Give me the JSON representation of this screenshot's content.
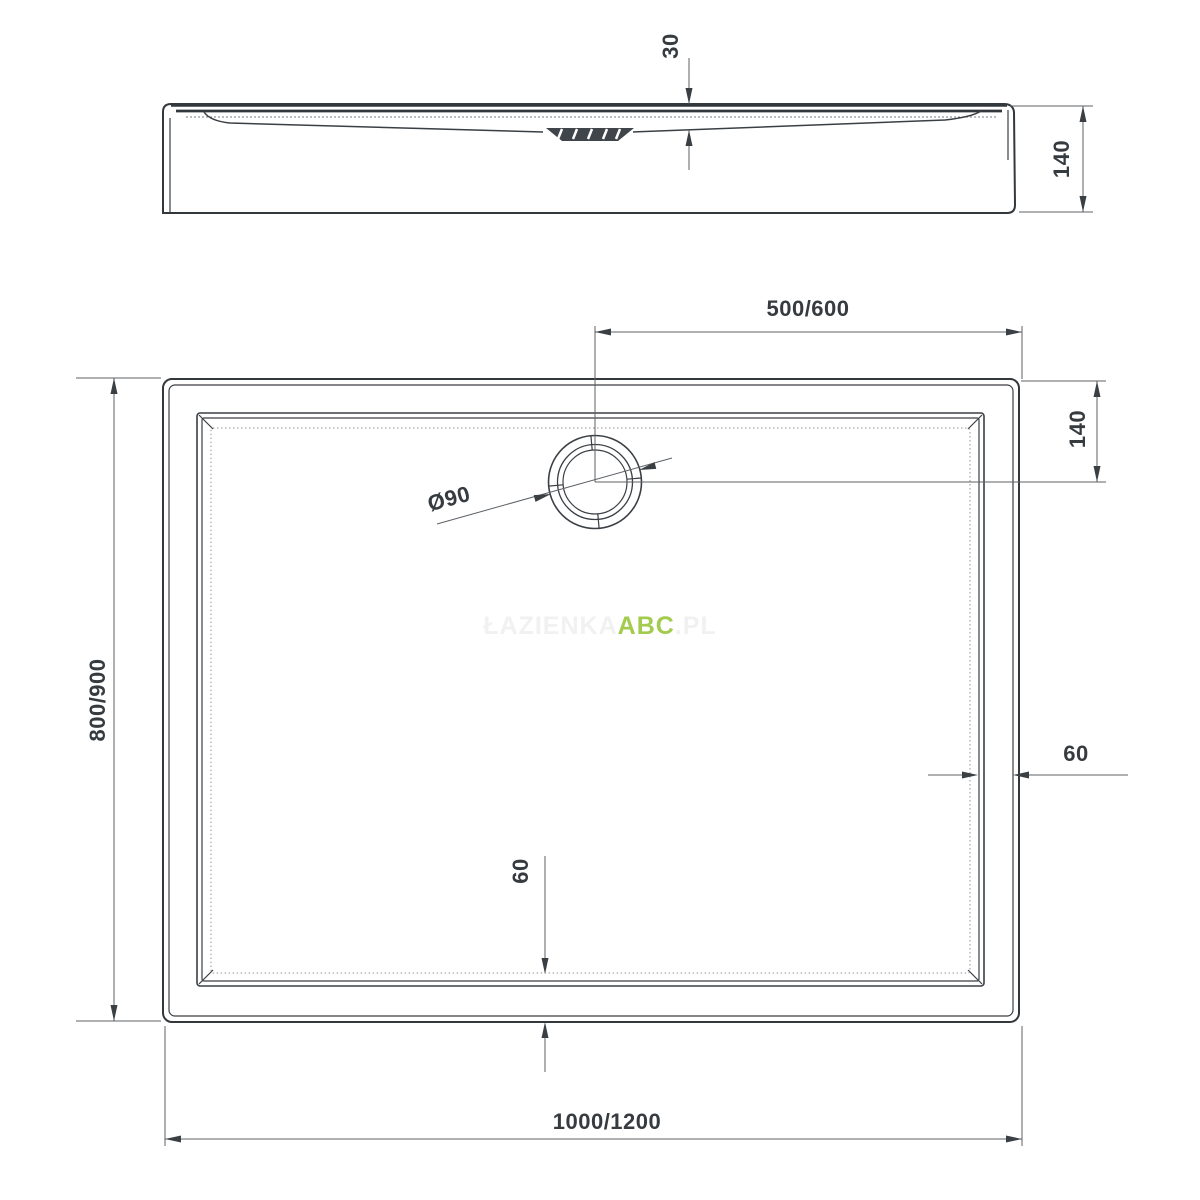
{
  "title": "Shower tray technical drawing",
  "watermark": {
    "prefix": "ŁAZIENKA",
    "brand": "ABC",
    "suffix": ".PL"
  },
  "colors": {
    "object_line": "#3a3f44",
    "dimension_line": "#5c6166",
    "text": "#363b40",
    "watermark_brand": "#a3cc4e",
    "watermark_faint": "#f1f1f1",
    "background": "#ffffff"
  },
  "section_view": {
    "dims": {
      "basin_depth": "30",
      "total_height": "140"
    }
  },
  "plan_view": {
    "dims": {
      "drain_from_edge_x": "500/600",
      "drain_from_edge_y": "140",
      "tray_width": "800/900",
      "tray_length": "1000/1200",
      "drain_diameter": "Ø90",
      "rim_width_right": "60",
      "rim_width_bottom": "60"
    }
  }
}
